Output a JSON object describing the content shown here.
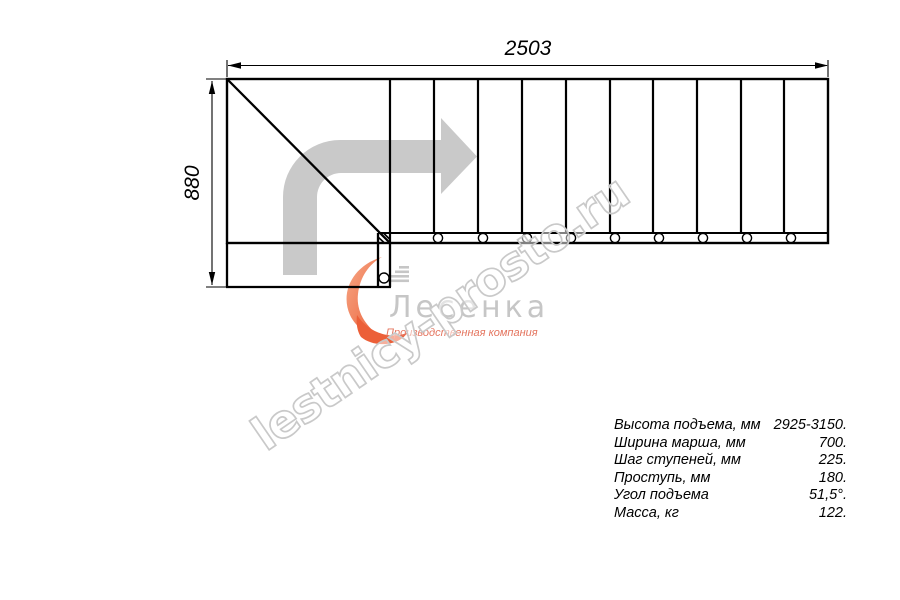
{
  "drawing": {
    "top_dimension_label": "2503",
    "left_dimension_label": "880",
    "line_color": "#000000",
    "direction_arrow_color": "#c9c9c9"
  },
  "watermark": {
    "text": "lestnicy-prosto.ru",
    "outline_color": "#c9c9c9"
  },
  "logo": {
    "name": "Лесенка",
    "name_color": "#c6c6c6",
    "tagline": "Производственная компания",
    "tagline_color": "#e4745e",
    "swoosh_color_light": "#f6a886",
    "swoosh_color_dark": "#ec5f38",
    "stairs_icon_color": "#c6c6c6"
  },
  "specs": {
    "rows": [
      {
        "label": "Высота подъема, мм",
        "value": "2925-3150."
      },
      {
        "label": "Ширина марша, мм",
        "value": "700."
      },
      {
        "label": "Шаг ступеней, мм",
        "value": "225."
      },
      {
        "label": "Проступь, мм",
        "value": "180."
      },
      {
        "label": "Угол подъема",
        "value": "51,5°."
      },
      {
        "label": "Масса, кг",
        "value": "122."
      }
    ]
  }
}
